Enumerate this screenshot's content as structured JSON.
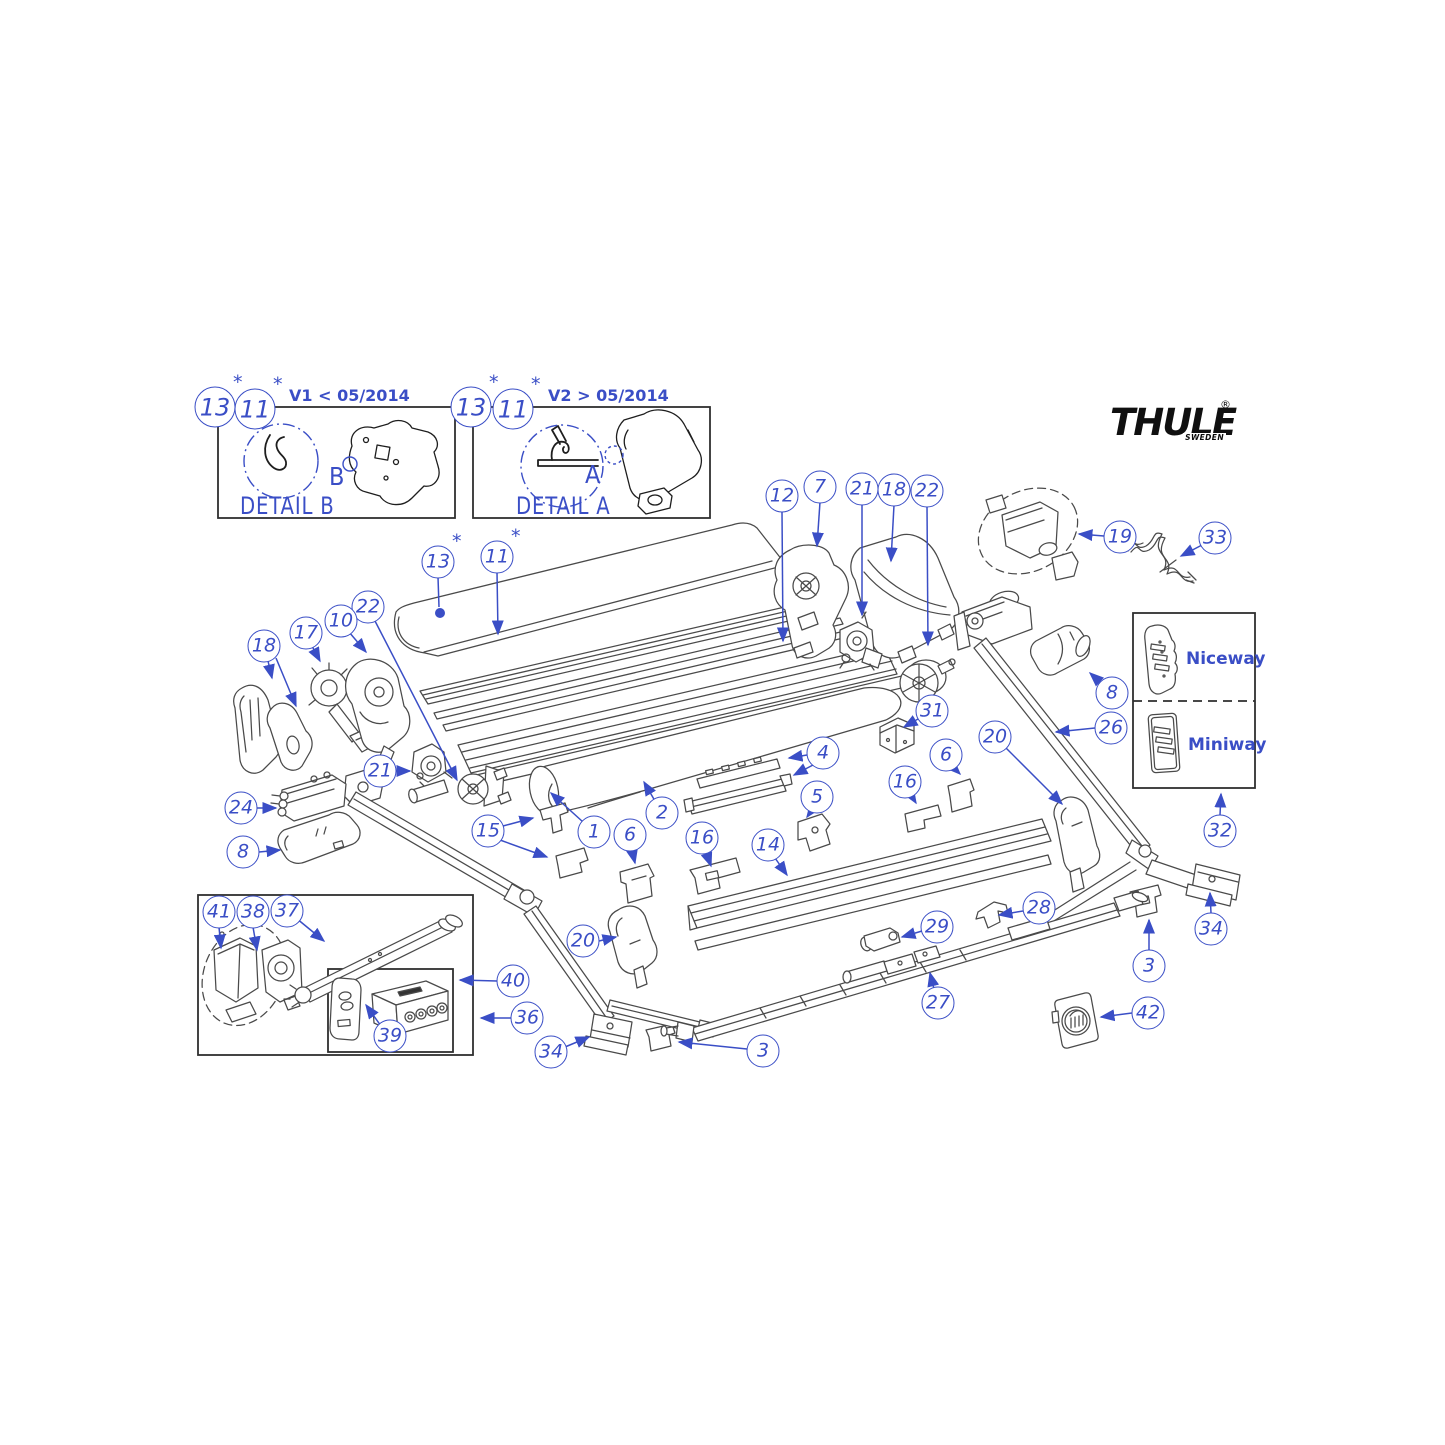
{
  "colors": {
    "callout_blue": "#3a4ec6",
    "line_dark": "#4a4a4a",
    "background": "#ffffff",
    "logo_black": "#101010"
  },
  "logo": {
    "brand": "THULE",
    "registered": "®",
    "subtext": "SWEDEN"
  },
  "annotation": {
    "asterisk": "*"
  },
  "detail_boxes": [
    {
      "id": "detail-b",
      "title": "DETAIL B",
      "zone_letter": "B",
      "version_note": "V1 < 05/2014"
    },
    {
      "id": "detail-a",
      "title": "DETAIL A",
      "zone_letter": "A",
      "version_note": "V2 > 05/2014"
    }
  ],
  "remote_panel": {
    "options": [
      "Niceway",
      "Miniway"
    ]
  },
  "part_callouts": [
    {
      "label": "13",
      "x": 215,
      "y": 407,
      "ast": true,
      "size": "lg"
    },
    {
      "label": "11",
      "x": 255,
      "y": 409,
      "ast": true,
      "size": "lg"
    },
    {
      "label": "13",
      "x": 471,
      "y": 407,
      "ast": true,
      "size": "lg"
    },
    {
      "label": "11",
      "x": 513,
      "y": 409,
      "ast": true,
      "size": "lg"
    },
    {
      "label": "12",
      "x": 782,
      "y": 496
    },
    {
      "label": "7",
      "x": 820,
      "y": 487
    },
    {
      "label": "21",
      "x": 862,
      "y": 489
    },
    {
      "label": "18",
      "x": 894,
      "y": 490
    },
    {
      "label": "22",
      "x": 927,
      "y": 491
    },
    {
      "label": "19",
      "x": 1120,
      "y": 537
    },
    {
      "label": "33",
      "x": 1215,
      "y": 538
    },
    {
      "label": "13",
      "x": 438,
      "y": 562,
      "ast": true
    },
    {
      "label": "11",
      "x": 497,
      "y": 557,
      "ast": true
    },
    {
      "label": "22",
      "x": 368,
      "y": 607
    },
    {
      "label": "10",
      "x": 341,
      "y": 621
    },
    {
      "label": "17",
      "x": 306,
      "y": 633
    },
    {
      "label": "18",
      "x": 264,
      "y": 646
    },
    {
      "label": "31",
      "x": 932,
      "y": 711
    },
    {
      "label": "8",
      "x": 1112,
      "y": 693
    },
    {
      "label": "26",
      "x": 1111,
      "y": 728
    },
    {
      "label": "20",
      "x": 995,
      "y": 737
    },
    {
      "label": "4",
      "x": 823,
      "y": 753
    },
    {
      "label": "6",
      "x": 946,
      "y": 755
    },
    {
      "label": "16",
      "x": 905,
      "y": 782
    },
    {
      "label": "5",
      "x": 817,
      "y": 797
    },
    {
      "label": "21",
      "x": 380,
      "y": 771
    },
    {
      "label": "24",
      "x": 241,
      "y": 808
    },
    {
      "label": "8",
      "x": 243,
      "y": 852
    },
    {
      "label": "15",
      "x": 488,
      "y": 831
    },
    {
      "label": "1",
      "x": 594,
      "y": 832
    },
    {
      "label": "6",
      "x": 630,
      "y": 835
    },
    {
      "label": "2",
      "x": 662,
      "y": 813
    },
    {
      "label": "16",
      "x": 702,
      "y": 838
    },
    {
      "label": "14",
      "x": 768,
      "y": 845
    },
    {
      "label": "32",
      "x": 1220,
      "y": 831
    },
    {
      "label": "34",
      "x": 1211,
      "y": 929
    },
    {
      "label": "20",
      "x": 583,
      "y": 941
    },
    {
      "label": "29",
      "x": 937,
      "y": 927
    },
    {
      "label": "28",
      "x": 1039,
      "y": 908
    },
    {
      "label": "3",
      "x": 1149,
      "y": 966
    },
    {
      "label": "27",
      "x": 938,
      "y": 1003
    },
    {
      "label": "42",
      "x": 1148,
      "y": 1013
    },
    {
      "label": "41",
      "x": 219,
      "y": 912
    },
    {
      "label": "38",
      "x": 253,
      "y": 912
    },
    {
      "label": "37",
      "x": 287,
      "y": 911
    },
    {
      "label": "40",
      "x": 513,
      "y": 981
    },
    {
      "label": "36",
      "x": 527,
      "y": 1018
    },
    {
      "label": "39",
      "x": 390,
      "y": 1036
    },
    {
      "label": "34",
      "x": 551,
      "y": 1052
    },
    {
      "label": "3",
      "x": 763,
      "y": 1051
    }
  ]
}
